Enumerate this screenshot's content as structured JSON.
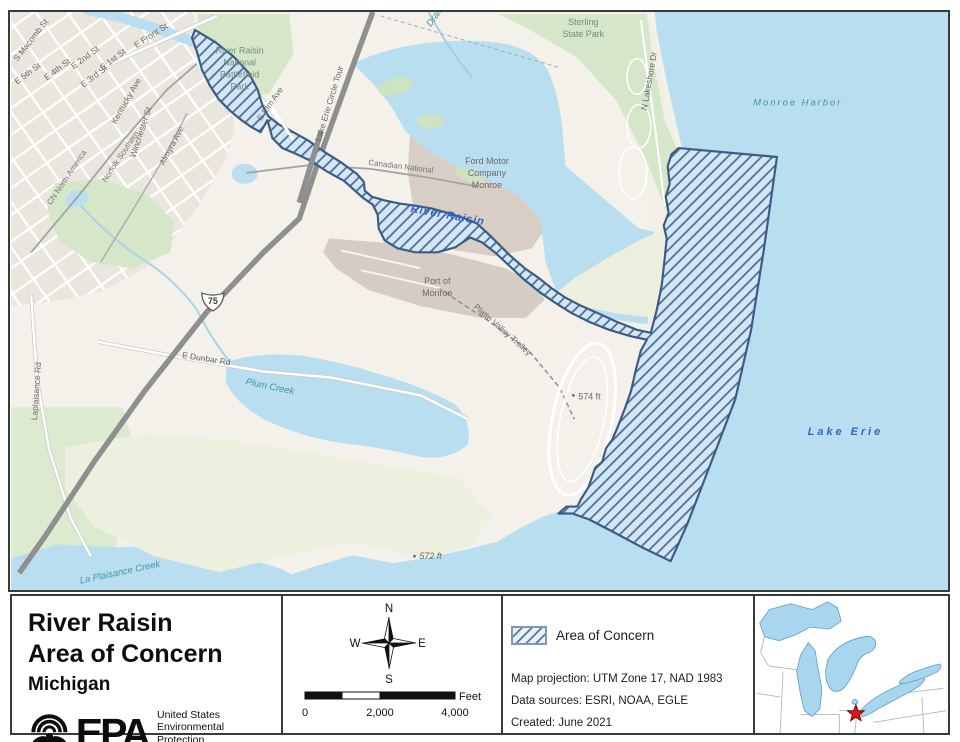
{
  "colors": {
    "aoc_fill": "#d3e6f6",
    "aoc_hatch": "#47688f",
    "aoc_outline": "#3d5c85",
    "water": "#b8def0",
    "land": "#f3f1ea",
    "green": "#d5e7c8",
    "marsh": "#eef0df",
    "industrial_brown": "#d8cec5",
    "water_label_teal": "#4592a7",
    "water_label_blue": "#2f63c9",
    "star_red": "#d7191c"
  },
  "map": {
    "streets": {
      "macomb": "S Macomb St",
      "front": "E Front St",
      "first": "E 1st St",
      "second": "E 2nd St",
      "third": "E 3rd St",
      "fourth": "E 4th St",
      "fifth": "E 5th St",
      "kentucky": "Kentucky Ave",
      "winchester": "Winchester St",
      "almyra": "Almyra Ave",
      "elm": "E Elm Ave",
      "circle_tour": "Lake Erie Circle Tour",
      "lakeshore": "N Lakeshore Dr",
      "dunbar": "E Dunbar Rd",
      "laplaisance": "Laplaisance Rd"
    },
    "railroads": {
      "cn_north_america": "CN North America",
      "norfolk_southern": "Norfolk Southern",
      "canadian_national": "Canadian National",
      "platte_valley_trolley": "Platte Valley Trolley"
    },
    "parks": {
      "battlefield": [
        "River Raisin",
        "National",
        "Battlefield",
        "Park"
      ],
      "sterling": [
        "Sterling",
        "State Park"
      ]
    },
    "places": {
      "ford": [
        "Ford Motor",
        "Company",
        "Monroe"
      ],
      "port": [
        "Port of",
        "Monroe"
      ],
      "elev_574": "574 ft",
      "elev_572": "572 ft"
    },
    "water": {
      "drain": "Drain",
      "monroe_harbor": "Monroe Harbor",
      "river_raisin": "River Raisin",
      "plum_creek": "Plum Creek",
      "la_plaisance_creek": "La Plaisance Creek",
      "lake_erie": "Lake Erie"
    },
    "highway_shield": "75"
  },
  "panel": {
    "title": {
      "line1": "River Raisin",
      "line2": "Area of Concern",
      "subtitle": "Michigan"
    },
    "epa": {
      "acronym": "EPA",
      "tagline": [
        "United States",
        "Environmental Protection",
        "Agency"
      ]
    },
    "compass": {
      "n": "N",
      "e": "E",
      "s": "S",
      "w": "W"
    },
    "scalebar": {
      "tick0": "0",
      "tick1": "2,000",
      "tick2": "4,000",
      "unit": "Feet"
    },
    "legend": {
      "aoc": "Area of Concern"
    },
    "credits": {
      "projection": "Map projection: UTM Zone 17, NAD 1983",
      "sources": "Data sources: ESRI, NOAA, EGLE",
      "created": "Created: June 2021"
    }
  }
}
